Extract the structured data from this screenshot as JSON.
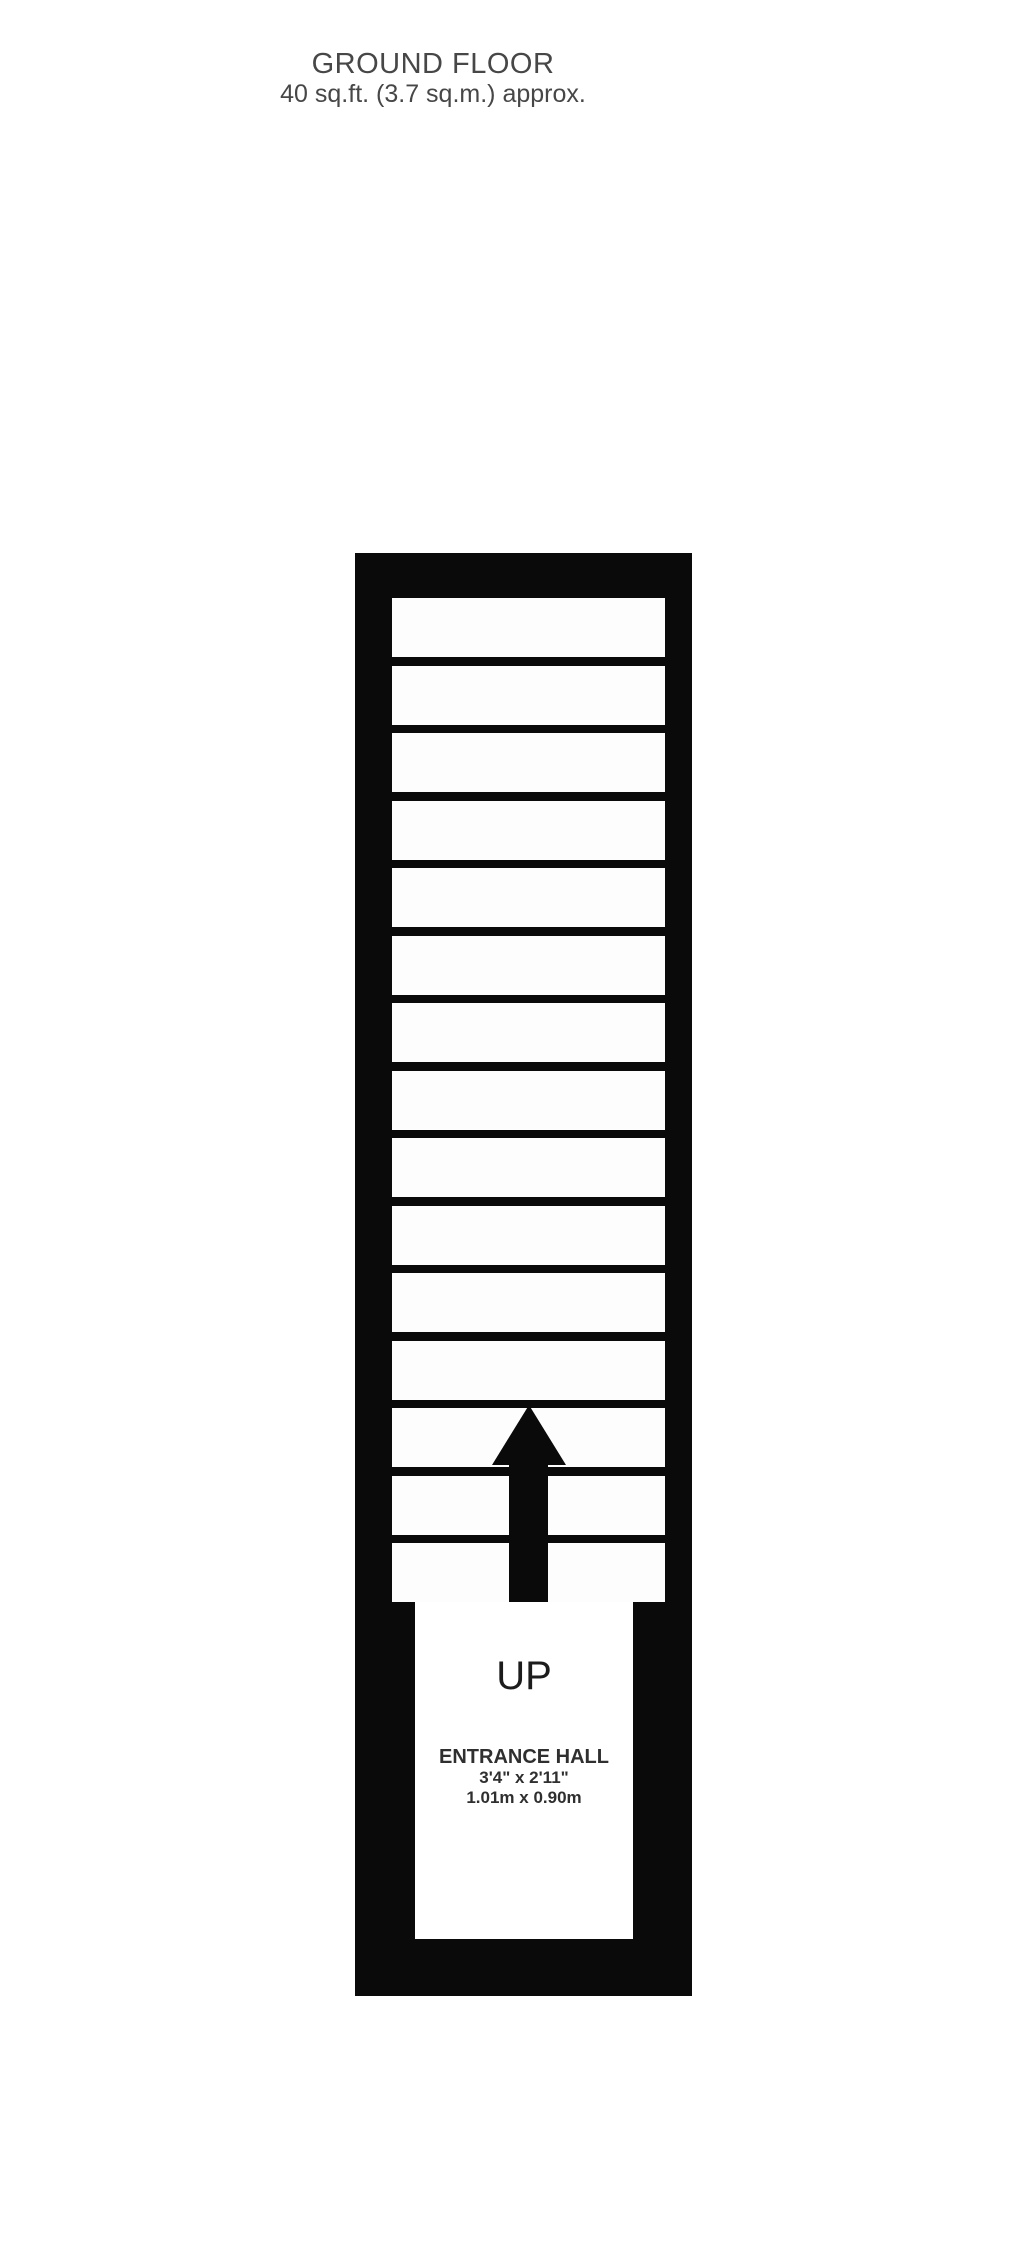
{
  "header": {
    "title": "GROUND FLOOR",
    "area": "40 sq.ft. (3.7 sq.m.) approx."
  },
  "floorplan": {
    "stairs": {
      "tread_count": 15,
      "direction_label": "UP"
    },
    "room": {
      "name": "ENTRANCE HALL",
      "dimensions_imperial": "3'4\" x 2'11\"",
      "dimensions_metric": "1.01m x 0.90m"
    },
    "icons": {
      "up_arrow": "black upward arrow over staircase"
    }
  },
  "colors": {
    "background": "#ffffff",
    "wall": "#0a0a0a",
    "tread": "#fdfdfd",
    "title_text": "#474747",
    "plan_text": "#2f2f2f"
  }
}
